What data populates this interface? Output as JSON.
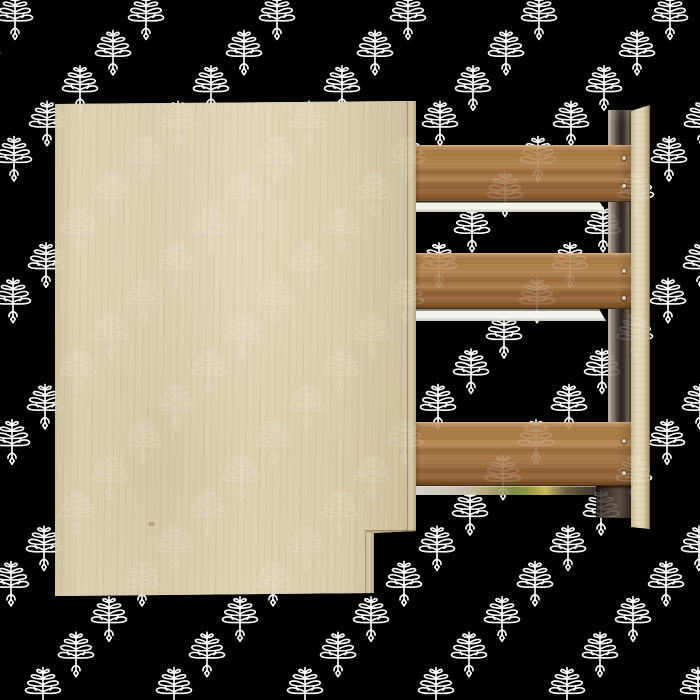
{
  "scene": {
    "description": "3D product render of a partially assembled wooden cabinet: a large birch front panel with a notched lower-right corner, three horizontal walnut slats with white drawer-slide rails attached to a rear mounting strip and a light birch side post, on a black background covered with a repeating white stylized tree watermark pattern.",
    "palette": {
      "background": "#000000",
      "watermark-white": "#ffffff",
      "panel-wood": "#ded0b2",
      "panel-edge": "#c3b28e",
      "slat-wood": "#a87a48",
      "slat-wood-dark": "#7a5029",
      "rail-white": "#f3f1ed",
      "rail-line": "#96908a",
      "rail3-green": "#7f8a46",
      "rail3-yellow": "#cdbb5e",
      "post-wood": "#e4d6b6",
      "strip-light": "#b3aaa0",
      "strip-dark": "#2c2520",
      "bracket-dark": "#3a312a",
      "screw": "#d8ccbd"
    },
    "watermark": {
      "motif": "stylized-tree-palmette",
      "color": "#ffffff",
      "start_x": 15,
      "start_y": 17,
      "col_spacing": 131,
      "row_spacing": 35.4,
      "row_shift": -33,
      "rows": 20,
      "motif_w": 40,
      "motif_h": 48,
      "front_opacity": 0.17
    },
    "furniture": {
      "panel": {
        "x": 55,
        "y": 98,
        "w": 365,
        "h": 499
      },
      "panel_edge_right": {
        "x": 352,
        "y": 2,
        "w": 9,
        "h": 432
      },
      "panel_edge_right_lower": {
        "x": 310,
        "y": 434,
        "w": 9,
        "h": 62
      },
      "panel_step_shade": {
        "x": 310,
        "y": 432,
        "w": 52,
        "h": 3
      },
      "panel_knot": {
        "x": 93,
        "y": 424,
        "w": 7,
        "h": 4
      },
      "back_strip": {
        "x": 608,
        "y": 110,
        "w": 24,
        "h": 407
      },
      "post": {
        "x": 631,
        "y": 105,
        "w": 19,
        "h": 424
      },
      "bracket": {
        "x": 596,
        "y": 486,
        "w": 36,
        "h": 32
      },
      "slats": [
        {
          "x": 412,
          "y": 145,
          "w": 221,
          "h": 57,
          "screws": [
            {
              "x": 210,
              "y": 11,
              "w": 4,
              "h": 4
            },
            {
              "x": 210,
              "y": 39,
              "w": 4,
              "h": 4
            }
          ]
        },
        {
          "x": 412,
          "y": 253,
          "w": 221,
          "h": 56,
          "screws": [
            {
              "x": 210,
              "y": 16,
              "w": 4,
              "h": 4
            },
            {
              "x": 210,
              "y": 43,
              "w": 4,
              "h": 4
            }
          ]
        },
        {
          "x": 412,
          "y": 422,
          "w": 221,
          "h": 64,
          "screws": [
            {
              "x": 210,
              "y": 17,
              "w": 4,
              "h": 4
            },
            {
              "x": 210,
              "y": 49,
              "w": 4,
              "h": 4
            }
          ]
        }
      ],
      "rails": [
        {
          "x": 412,
          "y": 201,
          "w": 194,
          "h": 11
        },
        {
          "x": 412,
          "y": 309,
          "w": 194,
          "h": 12
        },
        {
          "x": 412,
          "y": 485,
          "w": 196,
          "h": 10
        }
      ]
    }
  }
}
